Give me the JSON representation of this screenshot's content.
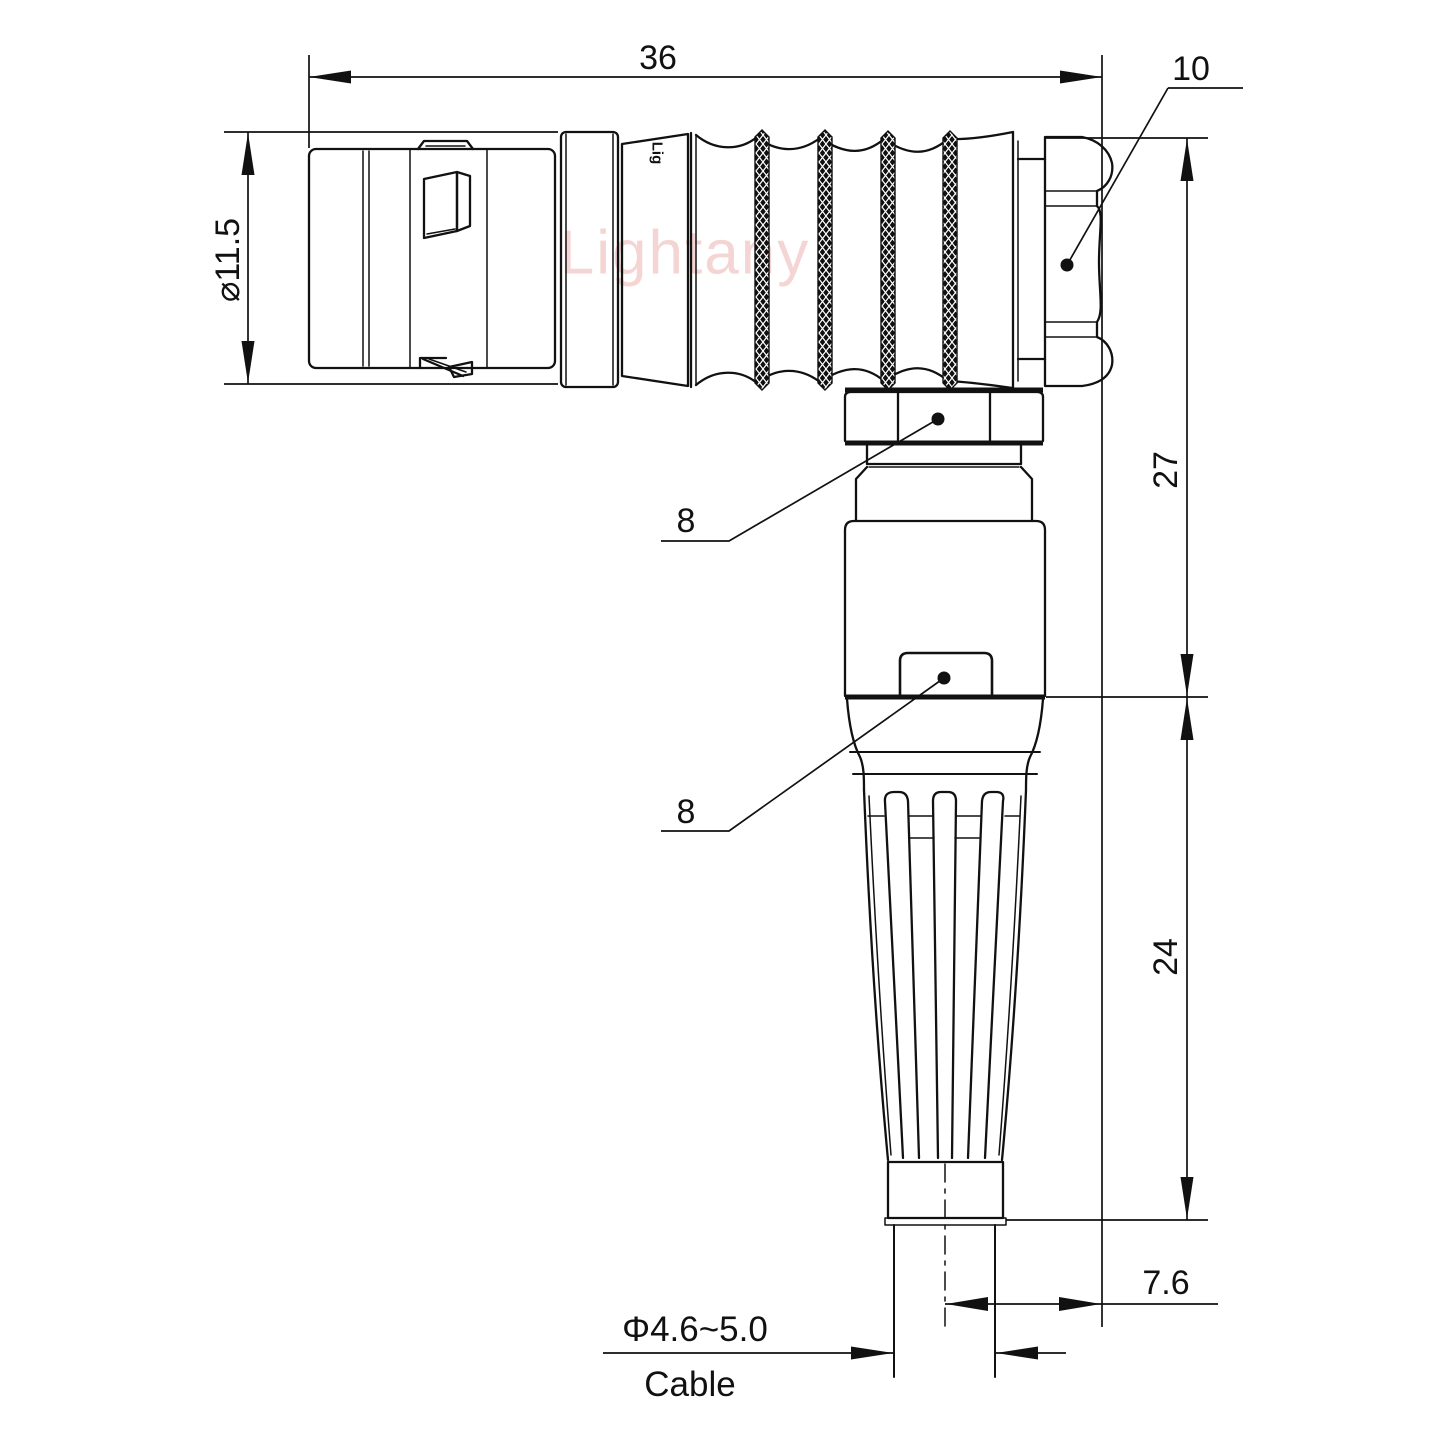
{
  "drawing": {
    "type": "technical-drawing",
    "view": "right-angle circular connector, side view with cable exit",
    "units": "mm",
    "watermark": "Lightany",
    "part_marking": "Lig",
    "colors": {
      "line": "#111111",
      "watermark": "#edb2b2",
      "background": "#ffffff"
    },
    "dimensions": {
      "overall_length": "36",
      "coupling_nut": "10",
      "shell_diameter": "⌀11.5",
      "height_upper": "27",
      "height_lower": "24",
      "hex_nut_leader": "8",
      "body_leader": "8",
      "cable_axis_offset": "7.6",
      "cable_diameter": "Φ4.6~5.0",
      "cable_label": "Cable"
    }
  }
}
